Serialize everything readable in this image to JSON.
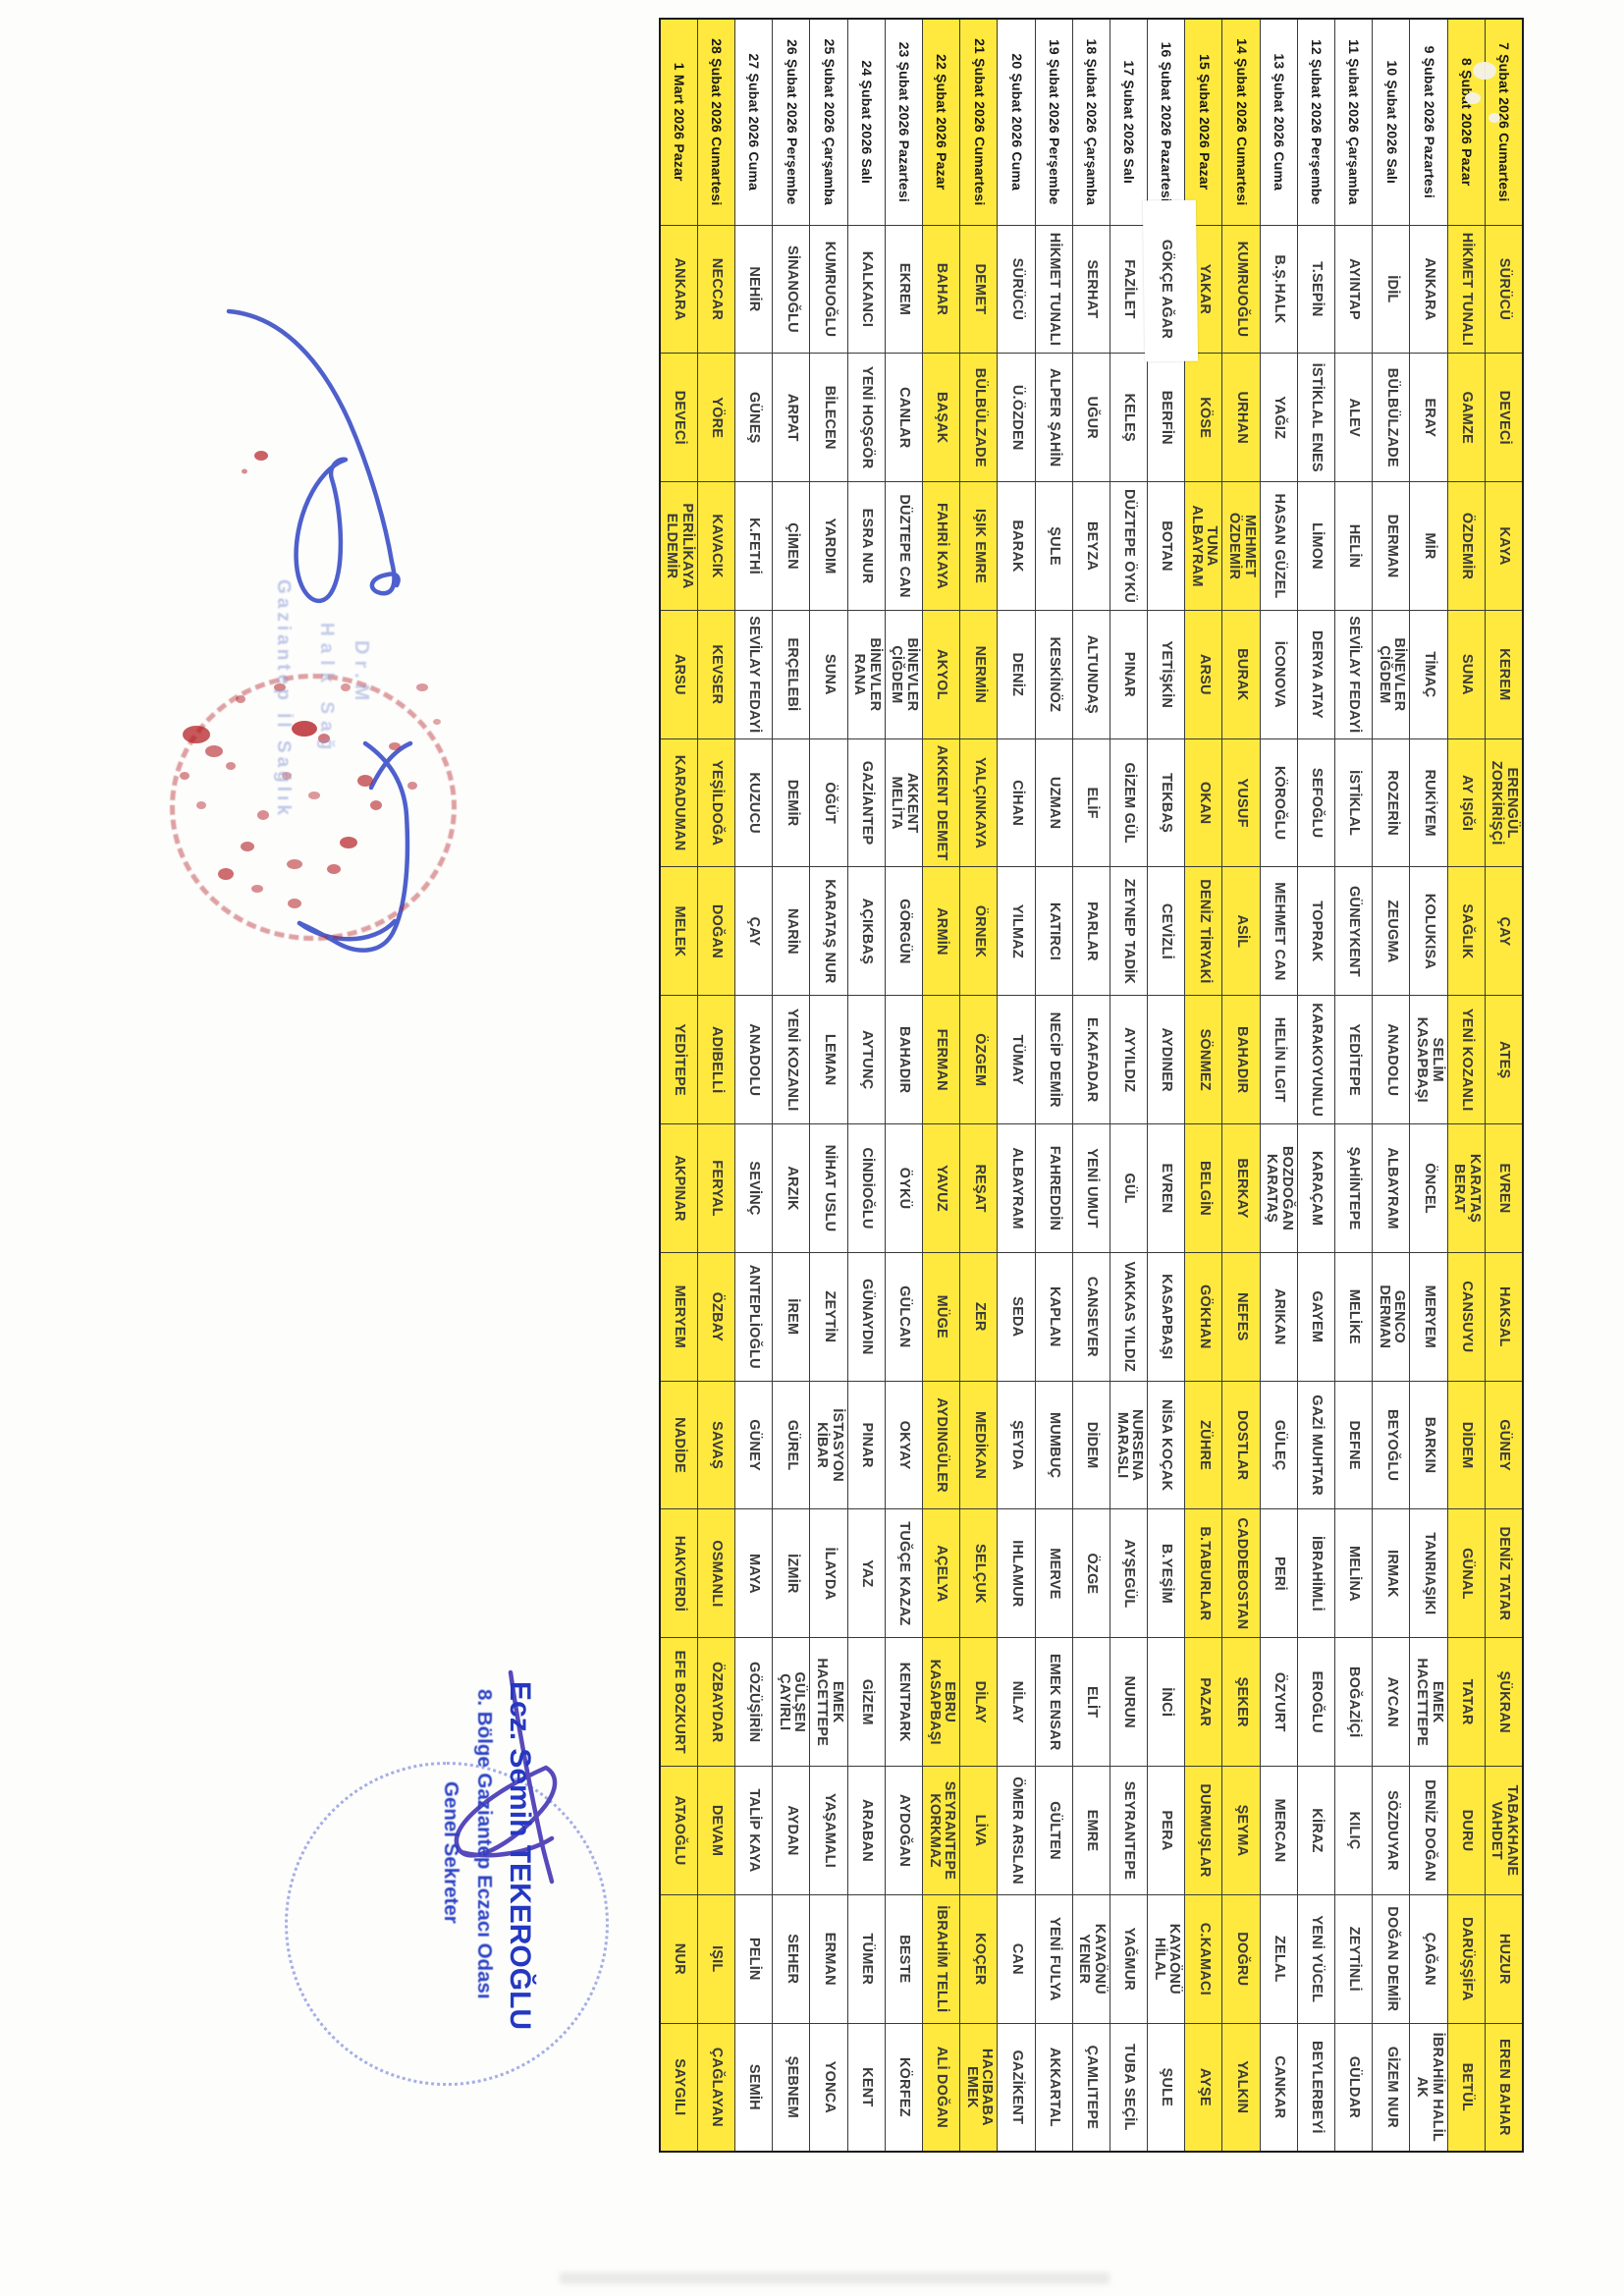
{
  "roster": {
    "weekend_color": "#ffe93e",
    "dates": [
      {
        "label": "7 Şubat 2026 Cumartesi",
        "weekend": true,
        "pharmacies": [
          "SÜRÜCÜ",
          "DEVECİ",
          "KAYA",
          "KEREM",
          "ERENGÜL ZORKİRİŞÇİ",
          "ÇAY",
          "ATEŞ",
          "EVREN",
          "HAKSAL",
          "GÜNEY",
          "DENİZ TATAR",
          "ŞÜKRAN",
          "TABAKHANE VAHDET",
          "HUZUR",
          "EREN BAHAR"
        ]
      },
      {
        "label": "8 Şubat 2026 Pazar",
        "weekend": true,
        "pharmacies": [
          "HİKMET TUNALI",
          "GAMZE",
          "ÖZDEMİR",
          "SUNA",
          "AY IŞIĞI",
          "SAĞLIK",
          "YENİ KOZANLI",
          "KARATAŞ BERAT",
          "CANSUYU",
          "DİDEM",
          "GÜNAL",
          "TATAR",
          "DURU",
          "DARÜŞŞİFA",
          "BETÜL"
        ]
      },
      {
        "label": "9 Şubat 2026 Pazartesi",
        "weekend": false,
        "pharmacies": [
          "ANKARA",
          "ERAY",
          "MİR",
          "TİMAÇ",
          "RUKİYEM",
          "KOLUKISA",
          "SELİM KASAPBAŞI",
          "ÖNCEL",
          "MERYEM",
          "BARKIN",
          "TANRIAŞIKI",
          "EMEK HACETTEPE",
          "DENİZ DOĞAN",
          "ÇAĞAN",
          "İBRAHİM HALİL AK"
        ]
      },
      {
        "label": "10 Şubat 2026 Salı",
        "weekend": false,
        "pharmacies": [
          "İDİL",
          "BÜLBÜLZADE",
          "DERMAN",
          "BİNEVLER ÇİĞDEM",
          "ROZERİN",
          "ZEUGMA",
          "ANADOLU",
          "ALBAYRAM",
          "GENCO DERMAN",
          "BEYOĞLU",
          "IRMAK",
          "AYCAN",
          "SÖZDUYAR",
          "DOĞAN DEMİR",
          "GİZEM NUR"
        ]
      },
      {
        "label": "11 Şubat 2026 Çarşamba",
        "weekend": false,
        "pharmacies": [
          "AYINTAP",
          "ALEV",
          "HELİN",
          "SEVİLAY FEDAYİ",
          "İSTİKLAL",
          "GÜNEYKENT",
          "YEDİTEPE",
          "ŞAHİNTEPE",
          "MELİKE",
          "DEFNE",
          "MELİNA",
          "BOĞAZİÇİ",
          "KILIÇ",
          "ZEYTİNLİ",
          "GÜLDAR"
        ]
      },
      {
        "label": "12 Şubat 2026 Perşembe",
        "weekend": false,
        "pharmacies": [
          "T.SEPİN",
          "İSTİKLAL ENES",
          "LİMON",
          "DERYA ATAY",
          "SEFOĞLU",
          "TOPRAK",
          "KARAKOYUNLU",
          "KARAÇAM",
          "GAYEM",
          "GAZİ MUHTAR",
          "İBRAHİMLİ",
          "EROĞLU",
          "KİRAZ",
          "YENİ YÜCEL",
          "BEYLERBEYİ"
        ]
      },
      {
        "label": "13 Şubat 2026 Cuma",
        "weekend": false,
        "pharmacies": [
          "B.Ş.HALK",
          "YAĞIZ",
          "HASAN GÜZEL",
          "İCONOVA",
          "KÖROĞLU",
          "MEHMET CAN",
          "HELİN ILGIT",
          "BOZDOĞAN KARATAŞ",
          "ARIKAN",
          "GÜLEÇ",
          "PERİ",
          "ÖZYURT",
          "MERCAN",
          "ZELAL",
          "CANKAR"
        ]
      },
      {
        "label": "14 Şubat 2026 Cumartesi",
        "weekend": true,
        "pharmacies": [
          "KUMRUOĞLU",
          "URHAN",
          "MEHMET ÖZDEMİR",
          "BURAK",
          "YUSUF",
          "ASİL",
          "BAHADIR",
          "BERKAY",
          "NEFES",
          "DOSTLAR",
          "CADDEBOSTAN",
          "ŞEKER",
          "ŞEYMA",
          "DOĞRU",
          "YALKIN"
        ]
      },
      {
        "label": "15 Şubat 2026 Pazar",
        "weekend": true,
        "pharmacies": [
          "YAKAR",
          "KÖSE",
          "TUNA ALBAYRAM",
          "ARSU",
          "OKAN",
          "DENİZ TİRYAKİ",
          "SÖNMEZ",
          "BELGİN",
          "GÖKHAN",
          "ZÜHRE",
          "B.TABURLAR",
          "PAZAR",
          "DURMUŞLAR",
          "C.KAMACI",
          "AYŞE"
        ]
      },
      {
        "label": "16 Şubat 2026 Pazartesi",
        "weekend": false,
        "pharmacies": [
          "GÖKÇE AĞAR",
          "BERFİN",
          "BOTAN",
          "YETİŞKİN",
          "TEKBAŞ",
          "CEVİZLİ",
          "AYDINER",
          "EVREN",
          "KASAPBAŞI",
          "NİSA KOÇAK",
          "B.YEŞİM",
          "İNCİ",
          "PERA",
          "KAYAÖNÜ HİLAL",
          "ŞULE"
        ]
      },
      {
        "label": "17 Şubat 2026 Salı",
        "weekend": false,
        "pharmacies": [
          "FAZİLET",
          "KELEŞ",
          "DÜZTEPE ÖYKÜ",
          "PINAR",
          "GİZEM GÜL",
          "ZEYNEP TADİK",
          "AYYILDIZ",
          "GÜL",
          "VAKKAS YILDIZ",
          "NURSENA MARASLI",
          "AYŞEGÜL",
          "NURUN",
          "SEYRANTEPE",
          "YAĞMUR",
          "TUBA SEÇİL"
        ]
      },
      {
        "label": "18 Şubat 2026 Çarşamba",
        "weekend": false,
        "pharmacies": [
          "SERHAT",
          "UĞUR",
          "BEYZA",
          "ALTUNDAŞ",
          "ELİF",
          "PARLAR",
          "E.KAFADAR",
          "YENİ UMUT",
          "CANSEVER",
          "DİDEM",
          "ÖZGE",
          "ELİT",
          "EMRE",
          "KAYAÖNÜ YENER",
          "ÇAMLITEPE"
        ]
      },
      {
        "label": "19 Şubat 2026 Perşembe",
        "weekend": false,
        "pharmacies": [
          "HİKMET TUNALI",
          "ALPER ŞAHİN",
          "ŞULE",
          "KESKİNÖZ",
          "UZMAN",
          "KATIRCI",
          "NECİP DEMİR",
          "FAHREDDİN",
          "KAPLAN",
          "MUMBUÇ",
          "MERVE",
          "EMEK ENSAR",
          "GÜLTEN",
          "YENİ FULYA",
          "AKKARTAL"
        ]
      },
      {
        "label": "20 Şubat 2026 Cuma",
        "weekend": false,
        "pharmacies": [
          "SÜRÜCÜ",
          "Ü.ÖZDEN",
          "BARAK",
          "DENİZ",
          "CİHAN",
          "YILMAZ",
          "TÜMAY",
          "ALBAYRAM",
          "SEDA",
          "ŞEYDA",
          "IHLAMUR",
          "NİLAY",
          "ÖMER ARSLAN",
          "CAN",
          "GAZİKENT"
        ]
      },
      {
        "label": "21 Şubat 2026 Cumartesi",
        "weekend": true,
        "pharmacies": [
          "DEMET",
          "BÜLBÜLZADE",
          "IŞIK EMRE",
          "NERMİN",
          "YALÇINKAYA",
          "ÖRNEK",
          "ÖZGEM",
          "REŞAT",
          "ZER",
          "MEDİKAN",
          "SELÇUK",
          "DİLAY",
          "LİVA",
          "KOÇER",
          "HACIBABA EMEK"
        ]
      },
      {
        "label": "22 Şubat 2026 Pazar",
        "weekend": true,
        "pharmacies": [
          "BAHAR",
          "BAŞAK",
          "FAHRİ KAYA",
          "AKYOL",
          "AKKENT DEMET",
          "ARMİN",
          "FERMAN",
          "YAVUZ",
          "MÜGE",
          "AYDINGÜLER",
          "AÇELYA",
          "EBRU KASAPBAŞI",
          "SEYRANTEPE KORKMAZ",
          "İBRAHİM TELLİ",
          "ALİ DOĞAN"
        ]
      },
      {
        "label": "23 Şubat 2026 Pazartesi",
        "weekend": false,
        "pharmacies": [
          "EKREM",
          "CANLAR",
          "DÜZTEPE CAN",
          "BİNEVLER ÇİĞDEM",
          "AKKENT MELİTA",
          "GÖRGÜN",
          "BAHADIR",
          "ÖYKÜ",
          "GÜLCAN",
          "OKYAY",
          "TUĞÇE KAZAZ",
          "KENTPARK",
          "AYDOĞAN",
          "BESTE",
          "KÖRFEZ"
        ]
      },
      {
        "label": "24 Şubat 2026 Salı",
        "weekend": false,
        "pharmacies": [
          "KALKANCI",
          "YENİ HOŞGÖR",
          "ESRA NUR",
          "BİNEVLER RANA",
          "GAZİANTEP",
          "AÇIKBAŞ",
          "AYTUNÇ",
          "CİNDİOĞLU",
          "GÜNAYDIN",
          "PINAR",
          "YAZ",
          "GİZEM",
          "ARABAN",
          "TÜMER",
          "KENT"
        ]
      },
      {
        "label": "25 Şubat 2026 Çarşamba",
        "weekend": false,
        "pharmacies": [
          "KUMRUOĞLU",
          "BİLECEN",
          "YARDIM",
          "SUNA",
          "ÖĞÜT",
          "KARATAŞ NUR",
          "LEMAN",
          "NİHAT USLU",
          "ZEYTİN",
          "İSTASYON KİBAR",
          "İLAYDA",
          "EMEK HACETTEPE",
          "YAŞAMALI",
          "ERMAN",
          "YONCA"
        ]
      },
      {
        "label": "26 Şubat 2026 Perşembe",
        "weekend": false,
        "pharmacies": [
          "SİNANOĞLU",
          "ARPAT",
          "ÇİMEN",
          "ERÇELEBİ",
          "DEMİR",
          "NARİN",
          "YENİ KOZANLI",
          "ARZIK",
          "İREM",
          "GÜREL",
          "İZMİR",
          "GÜLŞEN ÇAYIRLI",
          "AYDAN",
          "SEHER",
          "ŞEBNEM"
        ]
      },
      {
        "label": "27 Şubat 2026 Cuma",
        "weekend": false,
        "pharmacies": [
          "NEHİR",
          "GÜNEŞ",
          "K.FETHİ",
          "SEVİLAY FEDAYİ",
          "KUZUCU",
          "ÇAY",
          "ANADOLU",
          "SEVİNÇ",
          "ANTEPLİOĞLU",
          "GÜNEY",
          "MAYA",
          "GÖZÜŞİRİN",
          "TALİP KAYA",
          "PELİN",
          "SEMİH"
        ]
      },
      {
        "label": "28 Şubat 2026 Cumartesi",
        "weekend": true,
        "pharmacies": [
          "NECCAR",
          "YÖRE",
          "KAVACIK",
          "KEVSER",
          "YEŞİLDOĞA",
          "DOĞAN",
          "ADIBELLİ",
          "FERYAL",
          "ÖZBAY",
          "SAVAŞ",
          "OSMANLI",
          "ÖZBAYDAR",
          "DEVAM",
          "IŞIL",
          "ÇAĞLAYAN"
        ]
      },
      {
        "label": "1 Mart 2026 Pazar",
        "weekend": true,
        "pharmacies": [
          "ANKARA",
          "DEVECİ",
          "PERİLİKAYA ELDEMİR",
          "ARSU",
          "KARADUMAN",
          "MELEK",
          "YEDİTEPE",
          "AKPINAR",
          "MERYEM",
          "NADİDE",
          "HAKVERDİ",
          "EFE BOZKURT",
          "ATAOĞLU",
          "NUR",
          "SAYGILI"
        ]
      }
    ],
    "correction": {
      "date": "16 Şubat 2026 Pazartesi",
      "pharmacy": "GÖKÇE AĞAR"
    }
  },
  "stamps": {
    "top_faint_fragments": {
      "line1": "Gaziantep İl Sağlık",
      "line2": "Halk Sağ",
      "line3": "Dr.M"
    },
    "secretary": {
      "line1": "Ecz. Semih TEKEROĞLU",
      "line2": "8. Bölge Gaziantep Eczacı Odası",
      "line3": "Genel Sekreter"
    }
  },
  "colors": {
    "weekend_yellow": "#ffe93e",
    "grid": "#3a3a3a",
    "signature_blue": "#4053c8",
    "seal_red": "#b42025",
    "secretary_blue": "#2438c2"
  }
}
